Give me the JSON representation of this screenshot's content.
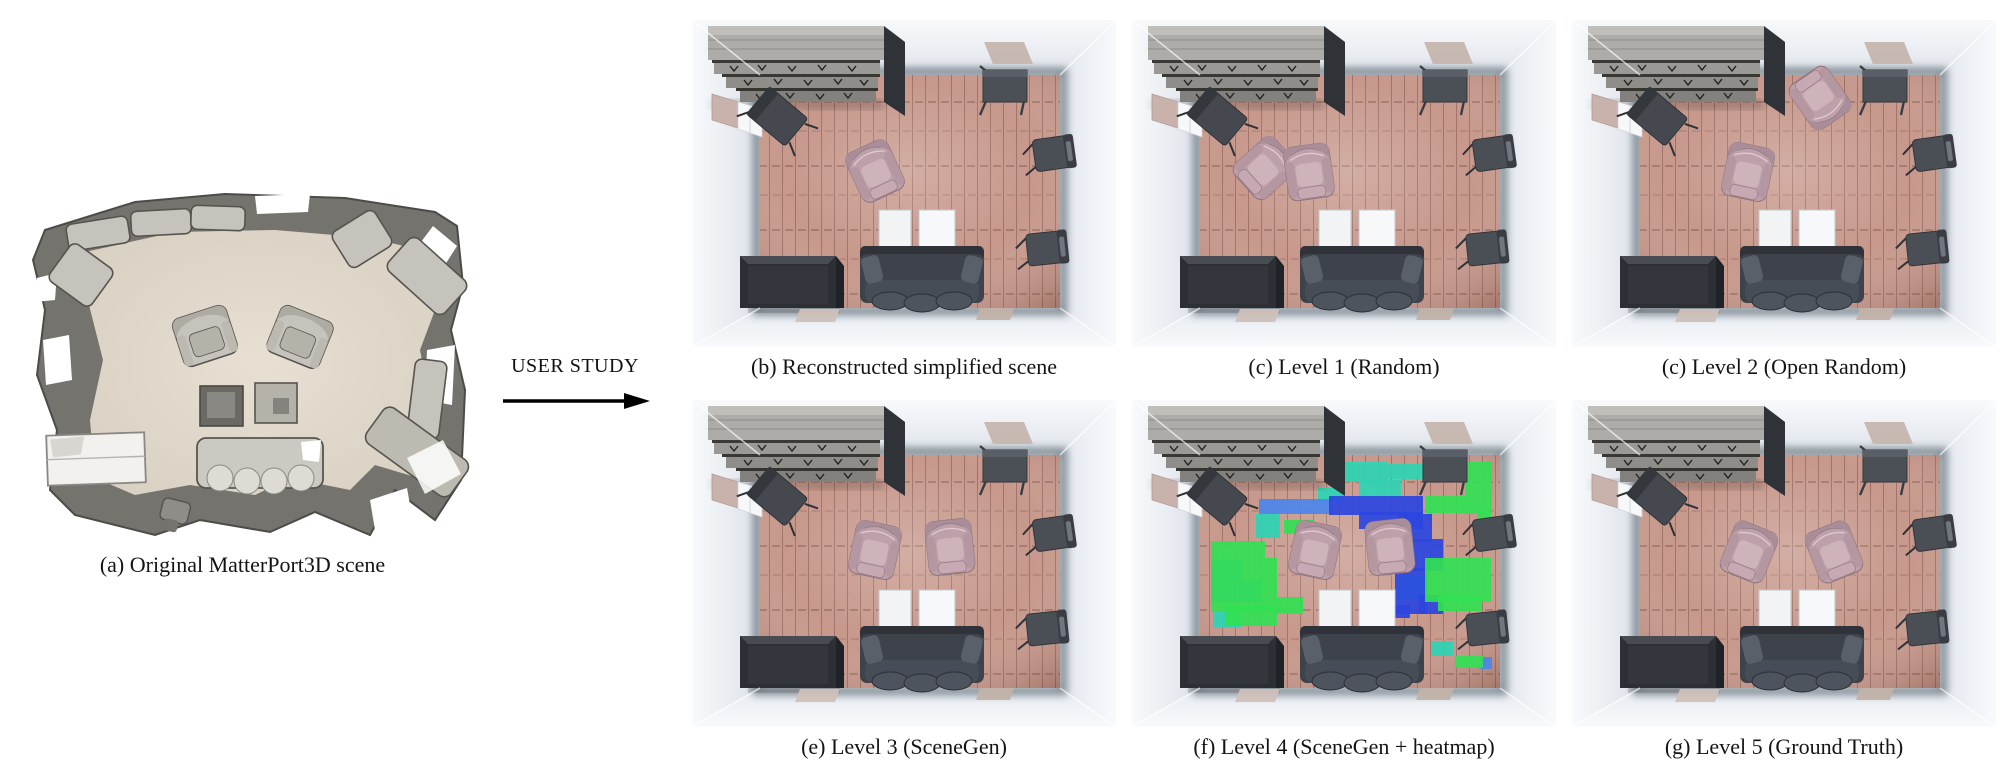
{
  "figure": {
    "arrow_label": "USER STUDY",
    "caption_a": "(a) Original MatterPort3D scene"
  },
  "panels": [
    {
      "caption": "(b) Reconstructed simplified scene",
      "heatmap": false,
      "chairs": [
        {
          "x": 183,
          "y": 151,
          "r": -25
        }
      ]
    },
    {
      "caption": "(c) Level 1 (Random)",
      "heatmap": false,
      "chairs": [
        {
          "x": 133,
          "y": 148,
          "r": 48
        },
        {
          "x": 177,
          "y": 152,
          "r": -8
        }
      ]
    },
    {
      "caption": "(c) Level 2 (Open Random)",
      "heatmap": false,
      "chairs": [
        {
          "x": 248,
          "y": 78,
          "r": 145
        },
        {
          "x": 176,
          "y": 152,
          "r": 12
        }
      ]
    },
    {
      "caption": "(e) Level 3 (SceneGen)",
      "heatmap": false,
      "chairs": [
        {
          "x": 183,
          "y": 150,
          "r": 12
        },
        {
          "x": 258,
          "y": 147,
          "r": -6
        }
      ]
    },
    {
      "caption": "(f) Level 4 (SceneGen + heatmap)",
      "heatmap": true,
      "chairs": [
        {
          "x": 183,
          "y": 150,
          "r": 12
        },
        {
          "x": 258,
          "y": 147,
          "r": -6
        }
      ]
    },
    {
      "caption": "(g) Level 5 (Ground Truth)",
      "heatmap": false,
      "chairs": [
        {
          "x": 177,
          "y": 152,
          "r": 22
        },
        {
          "x": 262,
          "y": 152,
          "r": -22
        }
      ]
    }
  ],
  "heatmap_cells": [
    [
      200,
      62,
      56,
      20,
      "t"
    ],
    [
      227,
      80,
      42,
      18,
      "t"
    ],
    [
      256,
      64,
      36,
      15,
      "t"
    ],
    [
      124,
      114,
      24,
      24,
      "t"
    ],
    [
      266,
      176,
      30,
      24,
      "t"
    ],
    [
      299,
      241,
      22,
      15,
      "t"
    ],
    [
      81,
      212,
      28,
      16,
      "t"
    ],
    [
      186,
      88,
      26,
      14,
      "t"
    ],
    [
      127,
      99,
      73,
      15,
      "l"
    ],
    [
      79,
      160,
      32,
      42,
      "l"
    ],
    [
      344,
      124,
      15,
      13,
      "l"
    ],
    [
      347,
      257,
      13,
      12,
      "l"
    ],
    [
      107,
      180,
      22,
      22,
      "l"
    ],
    [
      197,
      96,
      94,
      19,
      "b"
    ],
    [
      227,
      112,
      64,
      17,
      "b"
    ],
    [
      266,
      114,
      34,
      28,
      "b"
    ],
    [
      279,
      139,
      32,
      32,
      "b"
    ],
    [
      263,
      168,
      32,
      46,
      "b"
    ],
    [
      287,
      195,
      24,
      19,
      "b"
    ],
    [
      254,
      205,
      24,
      13,
      "b"
    ],
    [
      333,
      62,
      27,
      52,
      "g"
    ],
    [
      293,
      96,
      42,
      17,
      "g"
    ],
    [
      345,
      112,
      14,
      28,
      "g"
    ],
    [
      79,
      141,
      54,
      17,
      "g"
    ],
    [
      79,
      158,
      66,
      54,
      "g"
    ],
    [
      93,
      206,
      52,
      20,
      "g"
    ],
    [
      145,
      197,
      26,
      17,
      "g"
    ],
    [
      293,
      158,
      66,
      44,
      "g"
    ],
    [
      306,
      196,
      44,
      15,
      "g"
    ],
    [
      323,
      256,
      28,
      12,
      "g"
    ],
    [
      152,
      120,
      30,
      14,
      "g"
    ]
  ],
  "colors": {
    "heat": {
      "g": "#31e152",
      "t": "#2ed4b4",
      "l": "#4d86ec",
      "b": "#2b45df"
    },
    "floor_base": "#c7988b",
    "floor_plank": "rgba(92,52,45,0.38)",
    "wall_outer": "#f8fafc",
    "wall_top": "#dfe4eb",
    "wall_left": "#dde2e9",
    "wall_right": "#e2e7ee",
    "wall_bottom": "#e6eaf0",
    "chair_body": "#bda0aa",
    "chair_back": "#a98e99",
    "chair_arm": "#b497a1",
    "chair_seat": "#cfb3bb",
    "chair_foot": "#c6a9b2",
    "chair_stroke": "#8d717c",
    "dark_furniture": "#3e434b",
    "shelf_gray": "#aeaca8",
    "rug_tan": "#c6b5ae",
    "scan_wall": "#75736e",
    "scan_floor": "#d7cfc0",
    "scan_floor_light": "#e7e0d3",
    "scan_furniture": "#c6c3bc",
    "scan_stroke": "#57544f"
  }
}
